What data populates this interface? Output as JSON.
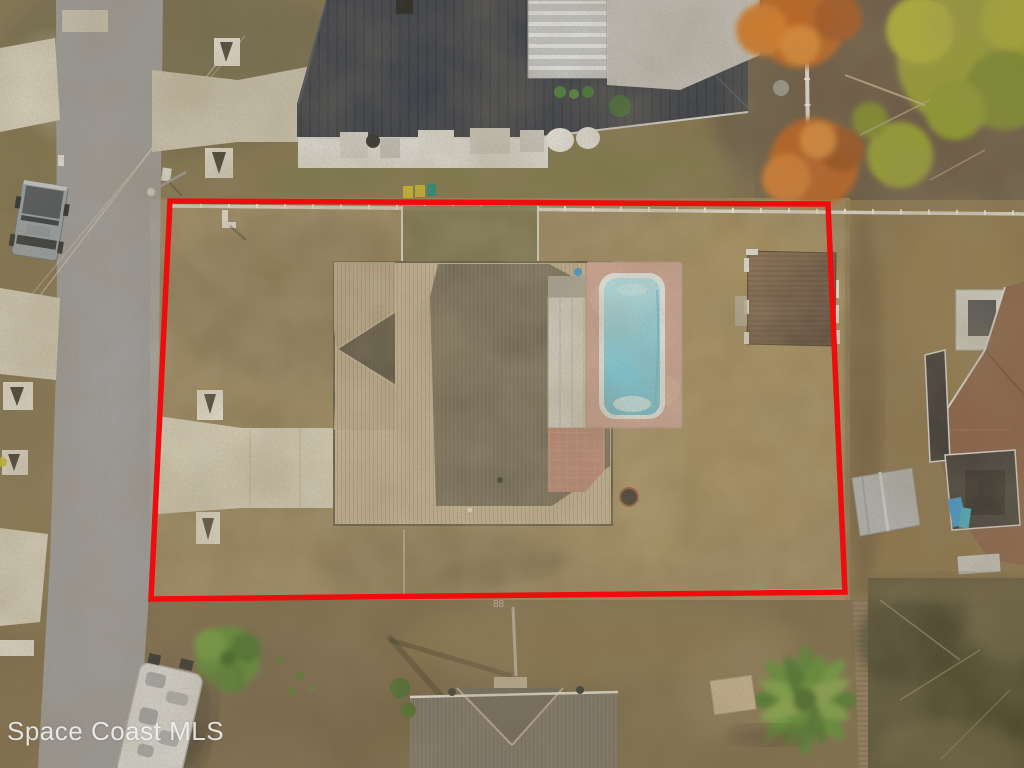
{
  "watermark": {
    "text": "Space Coast MLS"
  },
  "ground_mark": "88",
  "scene": {
    "type": "aerial-photo",
    "subject": "Aerial drone view of a single-family home with in-ground pool, lot outlined by red property boundary",
    "features": [
      "red property boundary",
      "asphalt street",
      "concrete driveway",
      "hip-roof house",
      "screened lanai",
      "in-ground pool",
      "pink pool deck",
      "brown shed",
      "white perimeter fence",
      "dog-run fence",
      "neighbor house dark metal roof",
      "neighbor house brown shingle roof",
      "gray shed",
      "orange autumn trees",
      "pine tree",
      "palm trees",
      "parked pickup truck",
      "parked RV",
      "fire pit",
      "culvert headwalls",
      "utility wires"
    ]
  },
  "colors": {
    "boundary": "#ee0c0c",
    "road": "#9d9d9f",
    "concrete": "#d8d1bd",
    "lawn": "#97825a",
    "house_roof_light": "#c6b495",
    "house_roof_dark": "#6f6755",
    "pool_water": "#7fd4ea",
    "pool_deck": "#d0a295",
    "lanai": "#d6d3cb",
    "shed_brown": "#6b4f39",
    "neighbor_roof_top": "#323846",
    "neighbor_roof_right": "#8a5f46",
    "fence": "#eceae0",
    "tree_orange": "#c2641f",
    "tree_pine": "#9aa02e",
    "palm": "#5d8f33",
    "rv": "#dfdfdd",
    "truck": "#97a0a8"
  }
}
